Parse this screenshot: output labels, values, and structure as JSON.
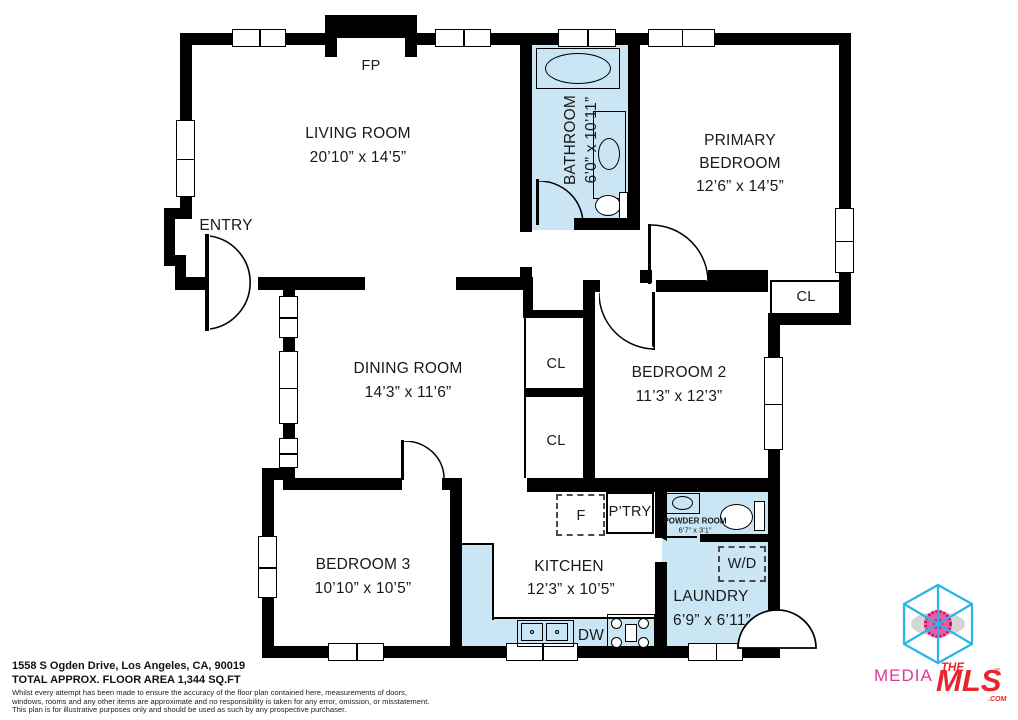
{
  "colors": {
    "wall": "#000000",
    "wet_room_fill": "#cae6f4",
    "background": "#ffffff",
    "logo_cyan": "#29b5e8",
    "logo_pink": "#e03795",
    "logo_red": "#e6252c"
  },
  "plan": {
    "fireplace_label": "FP",
    "entry_label": "ENTRY",
    "closet_label": "CL",
    "fridge_label": "F",
    "pantry_label": "P’TRY",
    "dishwasher_label": "DW",
    "washer_dryer_label": "W/D",
    "rooms": [
      {
        "name": "LIVING ROOM",
        "dims": "20’10” x 14’5”"
      },
      {
        "name": "BATHROOM",
        "dims": "6’0” x 10’11”"
      },
      {
        "name_line1": "PRIMARY",
        "name_line2": "BEDROOM",
        "dims": "12’6” x 14’5”"
      },
      {
        "name": "DINING ROOM",
        "dims": "14’3” x 11’6”"
      },
      {
        "name": "BEDROOM 2",
        "dims": "11’3” x 12’3”"
      },
      {
        "name": "BEDROOM 3",
        "dims": "10’10” x 10’5”"
      },
      {
        "name": "KITCHEN",
        "dims": "12’3” x 10’5”"
      },
      {
        "name": "POWDER ROOM",
        "dims": "6’7” x 3’1”"
      },
      {
        "name": "LAUNDRY",
        "dims": "6’9” x 6’11”"
      }
    ]
  },
  "footer": {
    "address": "1558 S Ogden Drive, Los Angeles, CA, 90019",
    "area": "TOTAL APPROX. FLOOR AREA 1,344 SQ.FT",
    "disclaimer_lines": [
      "Whilst every attempt has been made to ensure the accuracy of the floor plan contained here, measurements of doors,",
      "windows, rooms and any other items are approximate and no responsibility is taken for any error, omission, or misstatement.",
      "This plan is for illustrative purposes only and should be used as such by any prospective purchaser."
    ]
  },
  "logo": {
    "media": "MEDIA",
    "the": "THE",
    "mls": "MLS",
    "tm": "™",
    "com": ".COM"
  }
}
